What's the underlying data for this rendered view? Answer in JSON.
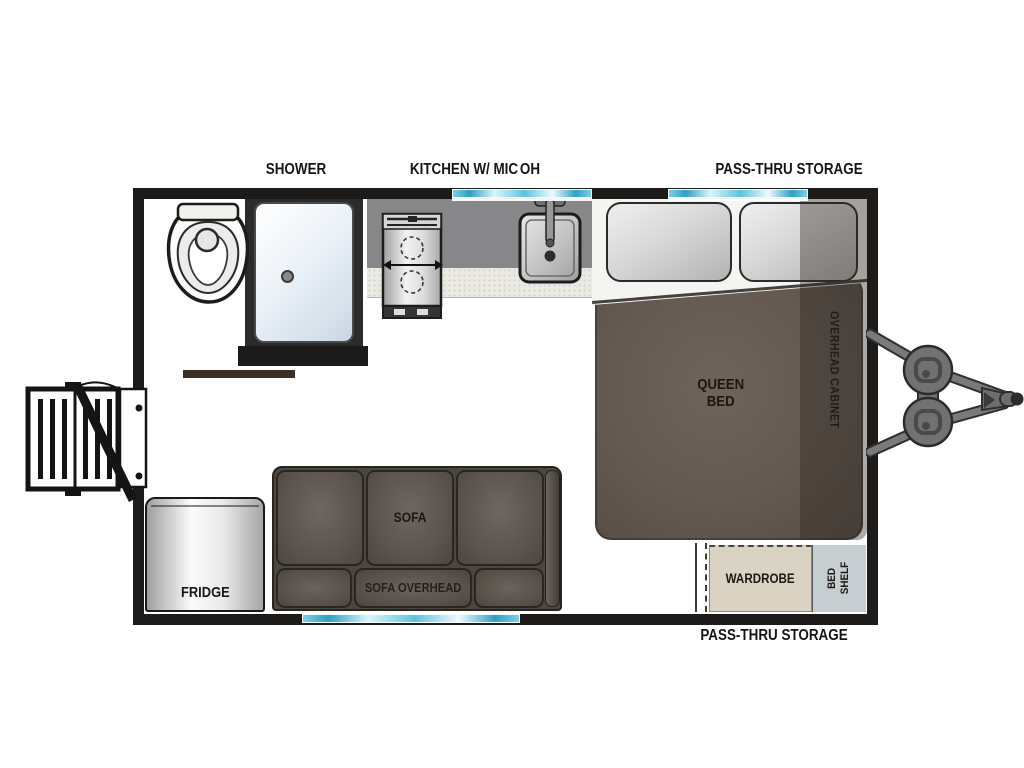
{
  "diagram": {
    "type": "travel-trailer-floorplan",
    "labels": {
      "shower": "SHOWER",
      "kitchen": "KITCHEN W/ MIC",
      "oh": "OH",
      "pass_thru_top": "PASS-THRU STORAGE",
      "pass_thru_bottom": "PASS-THRU STORAGE",
      "queen_bed": "QUEEN\nBED",
      "overhead_cabinet": "OVERHEAD CABINET",
      "sofa": "SOFA",
      "sofa_overhead": "SOFA OVERHEAD",
      "fridge": "FRIDGE",
      "wardrobe": "WARDROBE",
      "bed_shelf": "BED\nSHELF"
    },
    "fixture_icons": [
      "toilet-icon",
      "shower-stall-icon",
      "stove-icon",
      "sink-icon",
      "queen-bed",
      "sofa",
      "fridge",
      "wardrobe",
      "bed-shelf",
      "entry-steps-icon",
      "entry-door-icon",
      "propane-tanks-icon",
      "tow-hitch-icon",
      "window"
    ],
    "colors": {
      "wall": "#1d1b1a",
      "floor_wood": "#ad8262",
      "counter_gray": "#87878a",
      "counter_edge": "#ebe9e3",
      "window_teal": "#2f9fc4",
      "bed_brown": "#635951",
      "pillow_gray": "#d8d8d8",
      "sofa_gray": "#57504b",
      "wardrobe_beige": "#dad2c3",
      "bed_shelf_gray": "#c7ced2",
      "fridge_silver": "#e9e9e9",
      "hitch_gray": "#717171",
      "label_black": "#171512"
    }
  }
}
